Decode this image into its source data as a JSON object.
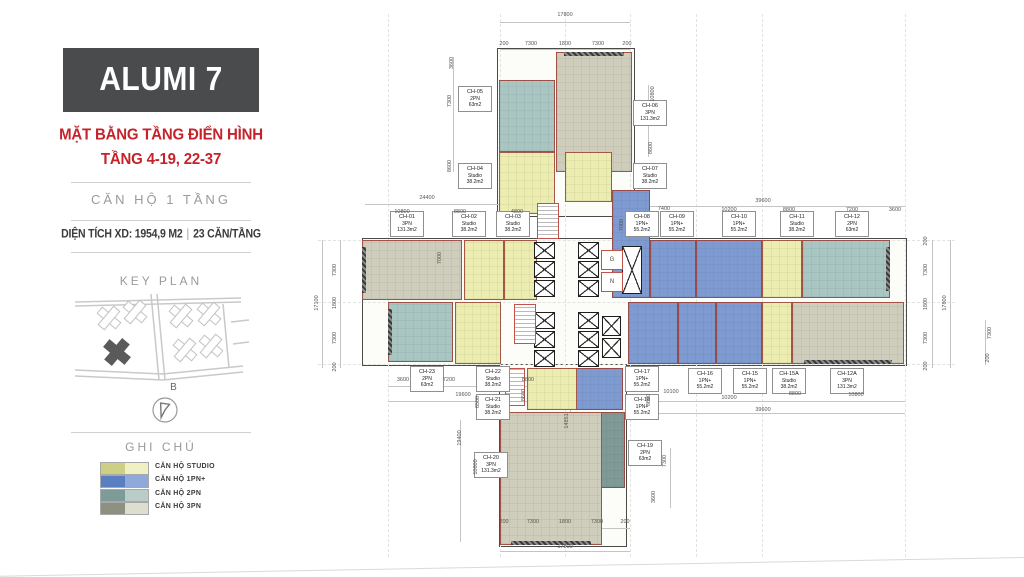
{
  "sidebar": {
    "title": "ALUMI 7",
    "subtitle_line1": "MẶT BẰNG TẦNG ĐIỂN HÌNH",
    "subtitle_line2": "TẦNG 4-19, 22-37",
    "unit_type_label": "CĂN HỘ 1 TẦNG",
    "area_info": "DIỆN TÍCH XD: 1954,9 M2",
    "separator": "|",
    "units_per_floor": "23 CĂN/TẦNG",
    "key_plan_label": "KEY PLAN",
    "compass_label": "B",
    "legend_title": "GHI CHÚ",
    "legend": [
      {
        "label": "CĂN HỘ STUDIO",
        "dark": "#cdd084",
        "light": "#eff0c3"
      },
      {
        "label": "CĂN HỘ 1PN+",
        "dark": "#5a7fc1",
        "light": "#8fa9da"
      },
      {
        "label": "CĂN HỘ 2PN",
        "dark": "#7d9b99",
        "light": "#b9ccc8"
      },
      {
        "label": "CĂN HỘ 3PN",
        "dark": "#8f9180",
        "light": "#deded0"
      }
    ],
    "colors": {
      "accent_red": "#c5222a",
      "header_bg": "#4a4b4d"
    }
  },
  "plan": {
    "units": [
      {
        "id": "CH-01",
        "type": "3PN",
        "area": "131.3m2",
        "cat": "pn3",
        "rect": [
          362,
          240,
          100,
          60
        ],
        "label": [
          390,
          211
        ],
        "bal": "left"
      },
      {
        "id": "CH-02",
        "type": "Studio",
        "area": "38.2m2",
        "cat": "studio",
        "rect": [
          464,
          240,
          40,
          60
        ],
        "label": [
          452,
          211
        ]
      },
      {
        "id": "CH-03",
        "type": "Studio",
        "area": "38.2m2",
        "cat": "studio",
        "rect": [
          504,
          240,
          33,
          60
        ],
        "label": [
          496,
          211
        ]
      },
      {
        "id": "CH-04",
        "type": "Studio",
        "area": "38.2m2",
        "cat": "studio",
        "rect": [
          499,
          152,
          56,
          62
        ],
        "label": [
          458,
          163
        ]
      },
      {
        "id": "CH-05",
        "type": "2PN",
        "area": "63m2",
        "cat": "pn2",
        "rect": [
          499,
          80,
          56,
          72
        ],
        "label": [
          458,
          86
        ]
      },
      {
        "id": "CH-06",
        "type": "3PN",
        "area": "131.3m2",
        "cat": "pn3",
        "rect": [
          556,
          52,
          76,
          120
        ],
        "label": [
          633,
          100
        ],
        "bal": "top"
      },
      {
        "id": "CH-07",
        "type": "Studio",
        "area": "38.2m2",
        "cat": "studio",
        "rect": [
          565,
          152,
          47,
          50
        ],
        "label": [
          633,
          163
        ]
      },
      {
        "id": "CH-08",
        "type": "1PN+",
        "area": "55.2m2",
        "cat": "pn1",
        "rect": [
          612,
          190,
          38,
          108
        ],
        "label": [
          625,
          211
        ]
      },
      {
        "id": "CH-09",
        "type": "1PN+",
        "area": "55.2m2",
        "cat": "pn1",
        "rect": [
          650,
          240,
          46,
          58
        ],
        "label": [
          660,
          211
        ]
      },
      {
        "id": "CH-10",
        "type": "1PN+",
        "area": "55.2m2",
        "cat": "pn1",
        "rect": [
          696,
          240,
          66,
          58
        ],
        "label": [
          722,
          211
        ]
      },
      {
        "id": "CH-11",
        "type": "Studio",
        "area": "38.2m2",
        "cat": "studio",
        "rect": [
          762,
          240,
          40,
          58
        ],
        "label": [
          780,
          211
        ]
      },
      {
        "id": "CH-12",
        "type": "2PN",
        "area": "63m2",
        "cat": "pn2",
        "rect": [
          802,
          240,
          88,
          58
        ],
        "label": [
          835,
          211
        ],
        "bal": "right"
      },
      {
        "id": "CH-12A",
        "type": "3PN",
        "area": "131.3m2",
        "cat": "pn3",
        "rect": [
          792,
          302,
          112,
          62
        ],
        "label": [
          830,
          368
        ],
        "bal": "bottom"
      },
      {
        "id": "CH-15A",
        "type": "Studio",
        "area": "38.2m2",
        "cat": "studio",
        "rect": [
          762,
          302,
          30,
          62
        ],
        "label": [
          772,
          368
        ]
      },
      {
        "id": "CH-15",
        "type": "1PN+",
        "area": "55.2m2",
        "cat": "pn1",
        "rect": [
          716,
          302,
          46,
          62
        ],
        "label": [
          733,
          368
        ]
      },
      {
        "id": "CH-16",
        "type": "1PN+",
        "area": "55.2m2",
        "cat": "pn1",
        "rect": [
          678,
          302,
          38,
          62
        ],
        "label": [
          688,
          368
        ]
      },
      {
        "id": "CH-18",
        "type": "1PN+",
        "area": "55.2m2",
        "cat": "pn1",
        "rect": [
          628,
          302,
          50,
          62
        ],
        "label": [
          625,
          394
        ]
      },
      {
        "id": "CH-17",
        "type": "1PN+",
        "area": "55.2m2",
        "cat": "pn1",
        "rect": [
          573,
          368,
          50,
          42
        ],
        "label": [
          625,
          366
        ]
      },
      {
        "id": "CH-19",
        "type": "2PN",
        "area": "63m2",
        "cat": "pn2d",
        "rect": [
          573,
          412,
          52,
          76
        ],
        "label": [
          628,
          440
        ]
      },
      {
        "id": "CH-20",
        "type": "3PN",
        "area": "131.3m2",
        "cat": "pn3",
        "rect": [
          500,
          412,
          102,
          133
        ],
        "label": [
          474,
          452
        ],
        "bal": "bottom"
      },
      {
        "id": "CH-21",
        "type": "Studio",
        "area": "38.2m2",
        "cat": "studio",
        "rect": [
          527,
          368,
          50,
          42
        ],
        "label": [
          476,
          394
        ]
      },
      {
        "id": "CH-22",
        "type": "Studio",
        "area": "38.2m2",
        "cat": "studio",
        "rect": [
          455,
          302,
          46,
          62
        ],
        "label": [
          476,
          366
        ]
      },
      {
        "id": "CH-23",
        "type": "2PN",
        "area": "63m2",
        "cat": "pn2",
        "rect": [
          388,
          302,
          65,
          60
        ],
        "label": [
          410,
          366
        ],
        "bal": "left"
      }
    ],
    "dims": [
      {
        "t": "17800",
        "x": 565,
        "y": 15
      },
      {
        "t": "200",
        "x": 504,
        "y": 44
      },
      {
        "t": "7300",
        "x": 531,
        "y": 44
      },
      {
        "t": "1800",
        "x": 565,
        "y": 44
      },
      {
        "t": "7300",
        "x": 598,
        "y": 44
      },
      {
        "t": "200",
        "x": 627,
        "y": 44
      },
      {
        "t": "3600",
        "x": 452,
        "y": 63,
        "r": 1
      },
      {
        "t": "7300",
        "x": 450,
        "y": 101,
        "r": 1
      },
      {
        "t": "8600",
        "x": 450,
        "y": 166,
        "r": 1
      },
      {
        "t": "10800",
        "x": 653,
        "y": 94,
        "r": 1
      },
      {
        "t": "8600",
        "x": 651,
        "y": 148,
        "r": 1
      },
      {
        "t": "24400",
        "x": 427,
        "y": 198
      },
      {
        "t": "10800",
        "x": 402,
        "y": 212
      },
      {
        "t": "8800",
        "x": 460,
        "y": 212
      },
      {
        "t": "4800",
        "x": 517,
        "y": 212
      },
      {
        "t": "7000",
        "x": 440,
        "y": 258,
        "r": 1
      },
      {
        "t": "17100",
        "x": 317,
        "y": 303,
        "r": 1
      },
      {
        "t": "7300",
        "x": 335,
        "y": 270,
        "r": 1
      },
      {
        "t": "1800",
        "x": 335,
        "y": 303,
        "r": 1
      },
      {
        "t": "7300",
        "x": 335,
        "y": 338,
        "r": 1
      },
      {
        "t": "200",
        "x": 335,
        "y": 367,
        "r": 1
      },
      {
        "t": "3600",
        "x": 403,
        "y": 380
      },
      {
        "t": "7200",
        "x": 449,
        "y": 380
      },
      {
        "t": "8800",
        "x": 528,
        "y": 380
      },
      {
        "t": "19600",
        "x": 463,
        "y": 395
      },
      {
        "t": "8600",
        "x": 524,
        "y": 395,
        "r": 1
      },
      {
        "t": "6500",
        "x": 478,
        "y": 402,
        "r": 1
      },
      {
        "t": "39600",
        "x": 763,
        "y": 201
      },
      {
        "t": "7400",
        "x": 664,
        "y": 209
      },
      {
        "t": "10200",
        "x": 729,
        "y": 210
      },
      {
        "t": "8800",
        "x": 789,
        "y": 210
      },
      {
        "t": "7200",
        "x": 852,
        "y": 210
      },
      {
        "t": "3600",
        "x": 895,
        "y": 210
      },
      {
        "t": "7000",
        "x": 622,
        "y": 225,
        "r": 1
      },
      {
        "t": "200",
        "x": 926,
        "y": 241,
        "r": 1
      },
      {
        "t": "7300",
        "x": 926,
        "y": 270,
        "r": 1
      },
      {
        "t": "1800",
        "x": 926,
        "y": 304,
        "r": 1
      },
      {
        "t": "7300",
        "x": 926,
        "y": 338,
        "r": 1
      },
      {
        "t": "200",
        "x": 926,
        "y": 366,
        "r": 1
      },
      {
        "t": "17800",
        "x": 945,
        "y": 303,
        "r": 1
      },
      {
        "t": "10100",
        "x": 671,
        "y": 392
      },
      {
        "t": "8600",
        "x": 649,
        "y": 400,
        "r": 1
      },
      {
        "t": "10200",
        "x": 729,
        "y": 398
      },
      {
        "t": "8800",
        "x": 795,
        "y": 394
      },
      {
        "t": "10800",
        "x": 856,
        "y": 395
      },
      {
        "t": "39600",
        "x": 763,
        "y": 410
      },
      {
        "t": "7300",
        "x": 990,
        "y": 333,
        "r": 1
      },
      {
        "t": "200",
        "x": 988,
        "y": 358,
        "r": 1
      },
      {
        "t": "19400",
        "x": 460,
        "y": 438,
        "r": 1
      },
      {
        "t": "10800",
        "x": 476,
        "y": 467,
        "r": 1
      },
      {
        "t": "14851",
        "x": 567,
        "y": 421,
        "r": 1
      },
      {
        "t": "7300",
        "x": 665,
        "y": 461,
        "r": 1
      },
      {
        "t": "3600",
        "x": 654,
        "y": 497,
        "r": 1
      },
      {
        "t": "200",
        "x": 504,
        "y": 522
      },
      {
        "t": "7300",
        "x": 533,
        "y": 522
      },
      {
        "t": "1800",
        "x": 565,
        "y": 522
      },
      {
        "t": "7300",
        "x": 597,
        "y": 522
      },
      {
        "t": "200",
        "x": 625,
        "y": 522
      },
      {
        "t": "17800",
        "x": 565,
        "y": 547
      }
    ],
    "core": {
      "rooms": [
        {
          "t": "G",
          "x": 601,
          "y": 250,
          "w": 22,
          "h": 20
        },
        {
          "t": "N",
          "x": 601,
          "y": 272,
          "w": 22,
          "h": 20
        }
      ],
      "elevators": [
        [
          534,
          242,
          21,
          17
        ],
        [
          534,
          261,
          21,
          17
        ],
        [
          534,
          280,
          21,
          17
        ],
        [
          578,
          242,
          21,
          17
        ],
        [
          578,
          261,
          21,
          17
        ],
        [
          578,
          280,
          21,
          17
        ],
        [
          534,
          312,
          21,
          17
        ],
        [
          534,
          331,
          21,
          17
        ],
        [
          534,
          350,
          21,
          17
        ],
        [
          578,
          312,
          21,
          17
        ],
        [
          578,
          331,
          21,
          17
        ],
        [
          578,
          350,
          21,
          17
        ],
        [
          602,
          316,
          19,
          20
        ],
        [
          602,
          338,
          19,
          20
        ],
        [
          622,
          246,
          20,
          48
        ]
      ],
      "stairs": [
        [
          537,
          203,
          22,
          36
        ],
        [
          514,
          304,
          22,
          40
        ],
        [
          505,
          368,
          20,
          38
        ]
      ]
    },
    "wings": [
      [
        497,
        48,
        136,
        167
      ],
      [
        362,
        238,
        543,
        126
      ],
      [
        499,
        364,
        126,
        181
      ]
    ],
    "dimlines": [
      [
        500,
        22,
        130,
        0
      ],
      [
        500,
        49,
        130,
        0
      ],
      [
        365,
        204,
        172,
        0
      ],
      [
        645,
        206,
        260,
        0
      ],
      [
        388,
        386,
        152,
        0
      ],
      [
        388,
        401,
        152,
        0
      ],
      [
        645,
        401,
        260,
        0
      ],
      [
        645,
        413,
        260,
        0
      ],
      [
        500,
        528,
        130,
        0
      ],
      [
        500,
        551,
        130,
        0
      ],
      [
        322,
        240,
        0,
        128
      ],
      [
        340,
        240,
        0,
        128
      ],
      [
        932,
        240,
        0,
        128
      ],
      [
        950,
        240,
        0,
        128
      ],
      [
        453,
        57,
        0,
        115
      ],
      [
        648,
        85,
        0,
        72
      ],
      [
        460,
        420,
        0,
        122
      ],
      [
        670,
        448,
        0,
        60
      ],
      [
        985,
        320,
        0,
        45
      ],
      [
        570,
        400,
        0,
        45
      ]
    ],
    "grid": {
      "v": [
        388,
        500,
        565,
        630,
        696,
        762,
        905
      ],
      "h": [
        240,
        302,
        364
      ]
    }
  }
}
